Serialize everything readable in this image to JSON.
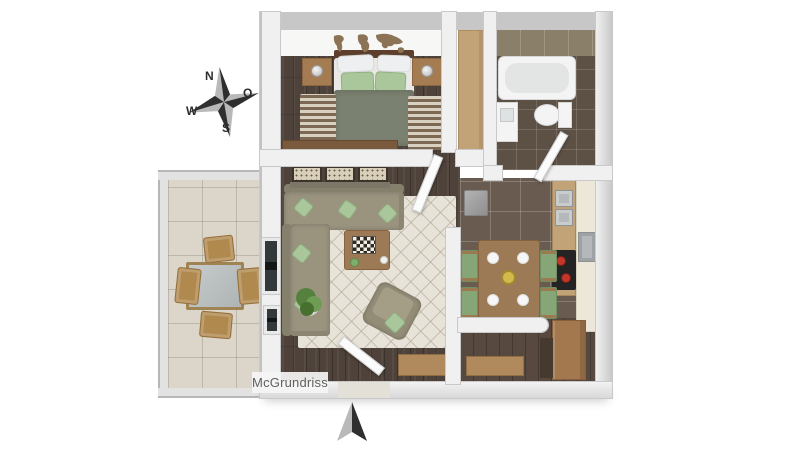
{
  "compass": {
    "labels": {
      "north": "N",
      "east": "O",
      "west": "W",
      "south": "S"
    }
  },
  "watermark": {
    "text": "McGrundriss"
  },
  "icons": {
    "compass_rose": "compass-rose-icon",
    "north_arrow": "north-arrow-icon",
    "world_map_decal": "world-map-icon"
  },
  "palette": {
    "wall": "#f0f0f0",
    "wall_outer": "#c7c7c7",
    "wood_floor": "#4e423a",
    "kitchen_tile": "#695b4f",
    "bath_tile": "#5d5146",
    "bath_wall_tile": "#8a8069",
    "balcony_tile": "#dbd6c9",
    "rug": "#e8e3d8",
    "sofa": "#9a947f",
    "cushion": "#a9c79b",
    "duvet": "#7b8171",
    "wood": "#9b7a55",
    "wood_light": "#c2a277",
    "counter_front": "#ece7d8",
    "fixture": "#f4f4f4",
    "stainless": "#b5b8ba",
    "cooktop": "#242424",
    "burner": "#c23728",
    "window_dark": "#151515",
    "plant": "#55813f",
    "chair_wood": "#b0894f",
    "map": "#8d7355",
    "arrow_dark": "#2f2f2f",
    "arrow_light": "#b9b9b9",
    "text_gray": "#5f5f5f"
  },
  "scene": {
    "type": "3d-floor-plan",
    "rooms": [
      {
        "name": "bedroom",
        "furniture": [
          "double-bed",
          "nightstands",
          "bedside-lamps",
          "runner-rugs",
          "sideboard",
          "world-map-decal"
        ]
      },
      {
        "name": "bathroom",
        "furniture": [
          "bathtub",
          "toilet",
          "sink-vanity",
          "tall-cabinet",
          "door"
        ]
      },
      {
        "name": "living-room",
        "furniture": [
          "corner-sofa",
          "coffee-table",
          "chessboard",
          "armchair",
          "area-rug",
          "potted-plant",
          "framed-prints",
          "console-table",
          "entrance-door",
          "balcony-window"
        ]
      },
      {
        "name": "kitchen-dining",
        "furniture": [
          "dining-table",
          "dining-chairs",
          "plates",
          "fruit-bowl",
          "kitchen-counter",
          "double-sink",
          "cooktop",
          "oven"
        ]
      },
      {
        "name": "hallway",
        "furniture": [
          "wardrobe",
          "shoe-rack",
          "cabinet",
          "stool"
        ]
      },
      {
        "name": "balcony",
        "furniture": [
          "glass-table",
          "wooden-chairs",
          "glass-railing"
        ]
      }
    ]
  }
}
